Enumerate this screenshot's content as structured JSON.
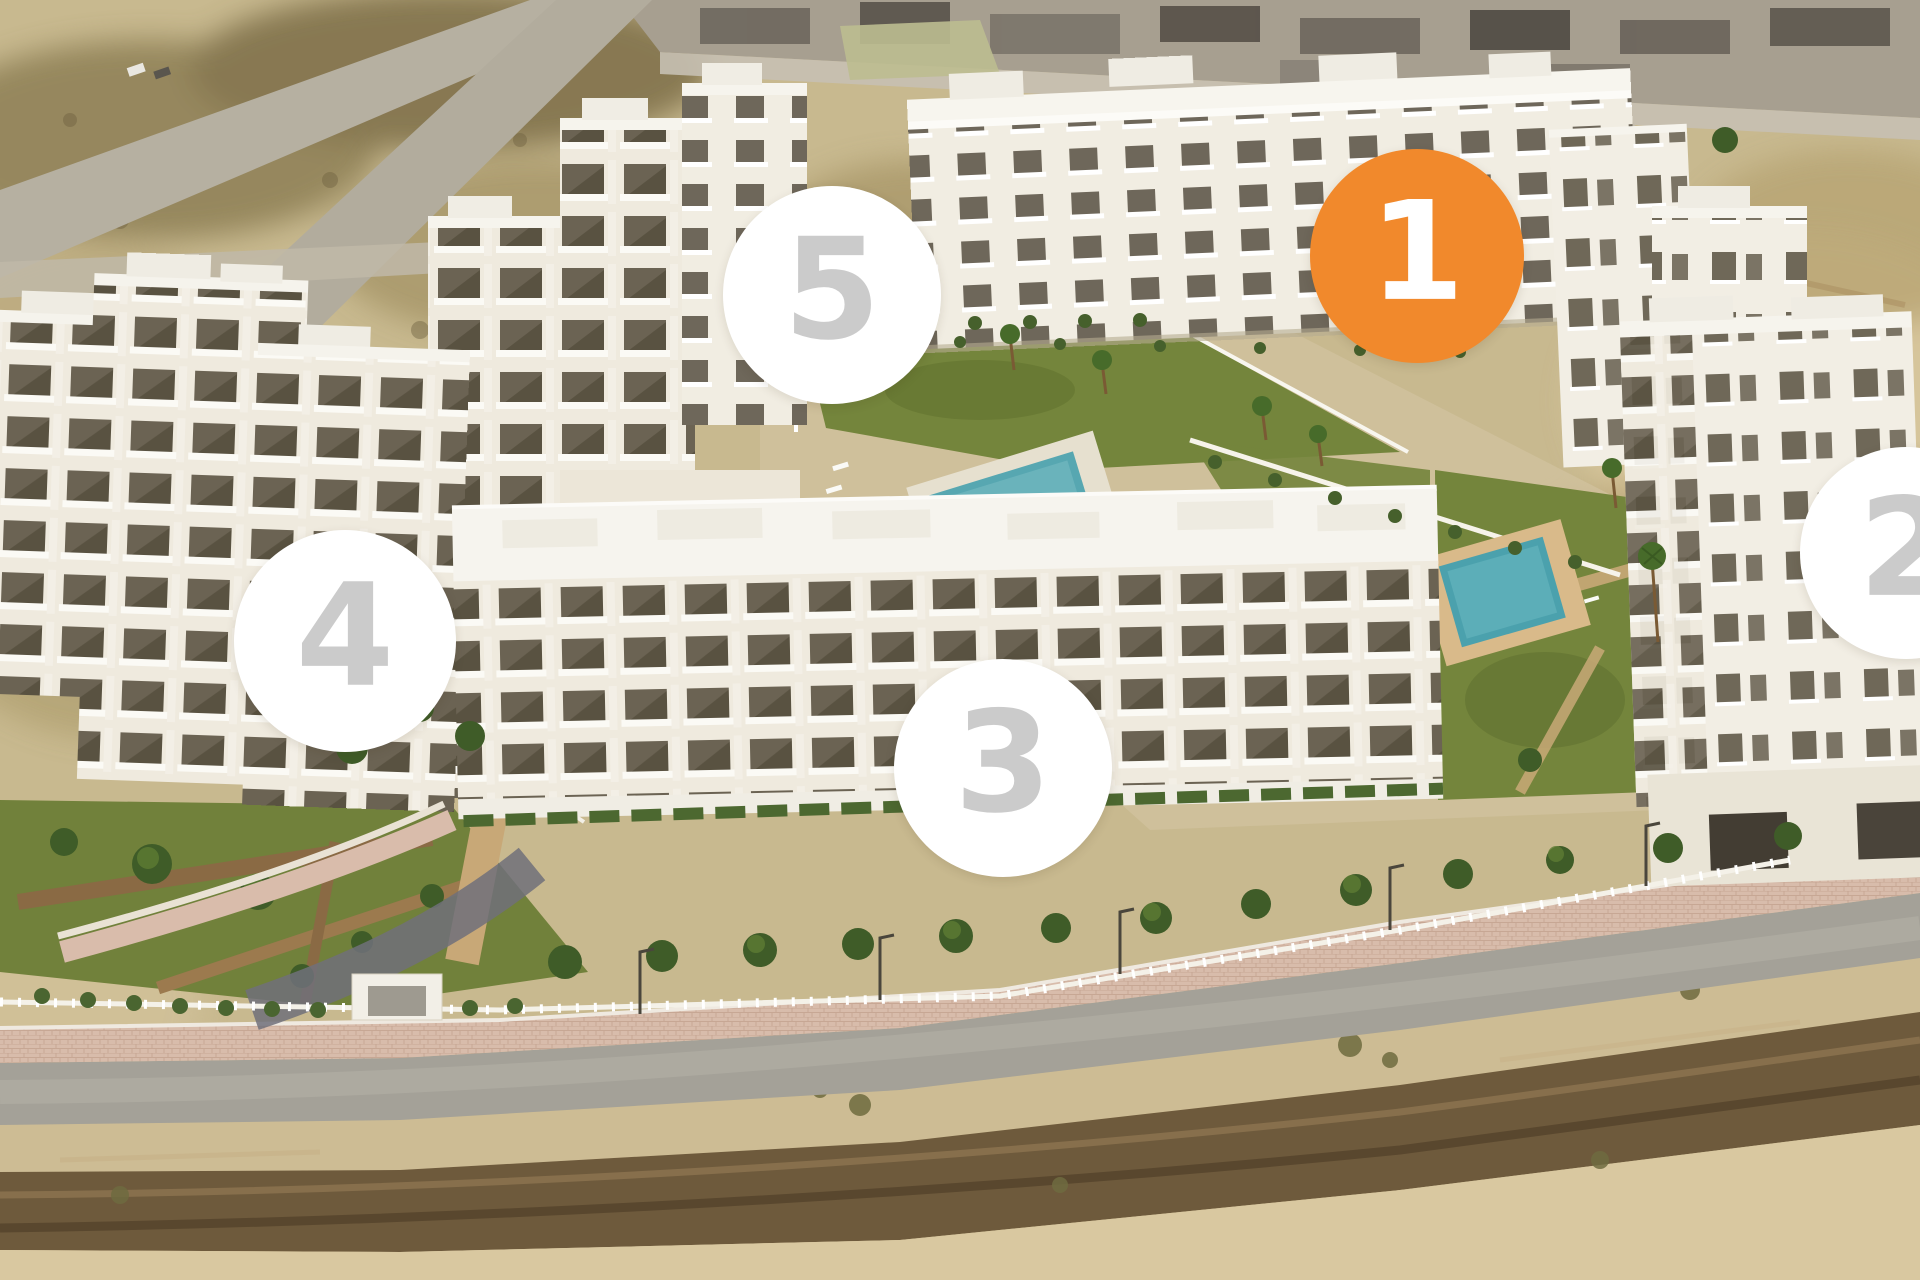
{
  "view": {
    "name": "Residential development aerial plan",
    "description": "Aerial 3D rendering of a five-phase white apartment complex with central gardens, two swimming pools, perimeter fence and a road along the front; phase 1 is highlighted in orange."
  },
  "markers": [
    {
      "id": "phase-1",
      "label": "1",
      "state": "selected",
      "fill": "#F1892C",
      "number_color": "#FFFFFF",
      "cx": 1417,
      "cy": 256,
      "diameter": 214
    },
    {
      "id": "phase-2",
      "label": "2",
      "state": "default",
      "fill": "#FFFFFF",
      "number_color": "#CBCBCB",
      "cx": 1906,
      "cy": 553,
      "diameter": 212
    },
    {
      "id": "phase-3",
      "label": "3",
      "state": "default",
      "fill": "#FFFFFF",
      "number_color": "#CBCBCB",
      "cx": 1003,
      "cy": 768,
      "diameter": 218
    },
    {
      "id": "phase-4",
      "label": "4",
      "state": "default",
      "fill": "#FFFFFF",
      "number_color": "#CBCBCB",
      "cx": 345,
      "cy": 641,
      "diameter": 222
    },
    {
      "id": "phase-5",
      "label": "5",
      "state": "default",
      "fill": "#FFFFFF",
      "number_color": "#CBCBCB",
      "cx": 832,
      "cy": 295,
      "diameter": 218
    }
  ],
  "scene_palette": {
    "sand": "#C9BA92",
    "road": "#A4A198",
    "sidewalk": "#D8BCAB",
    "lawn": "#74853C",
    "pool": "#55A6B0",
    "building": "#EFEADE",
    "tree": "#3F5C28"
  }
}
